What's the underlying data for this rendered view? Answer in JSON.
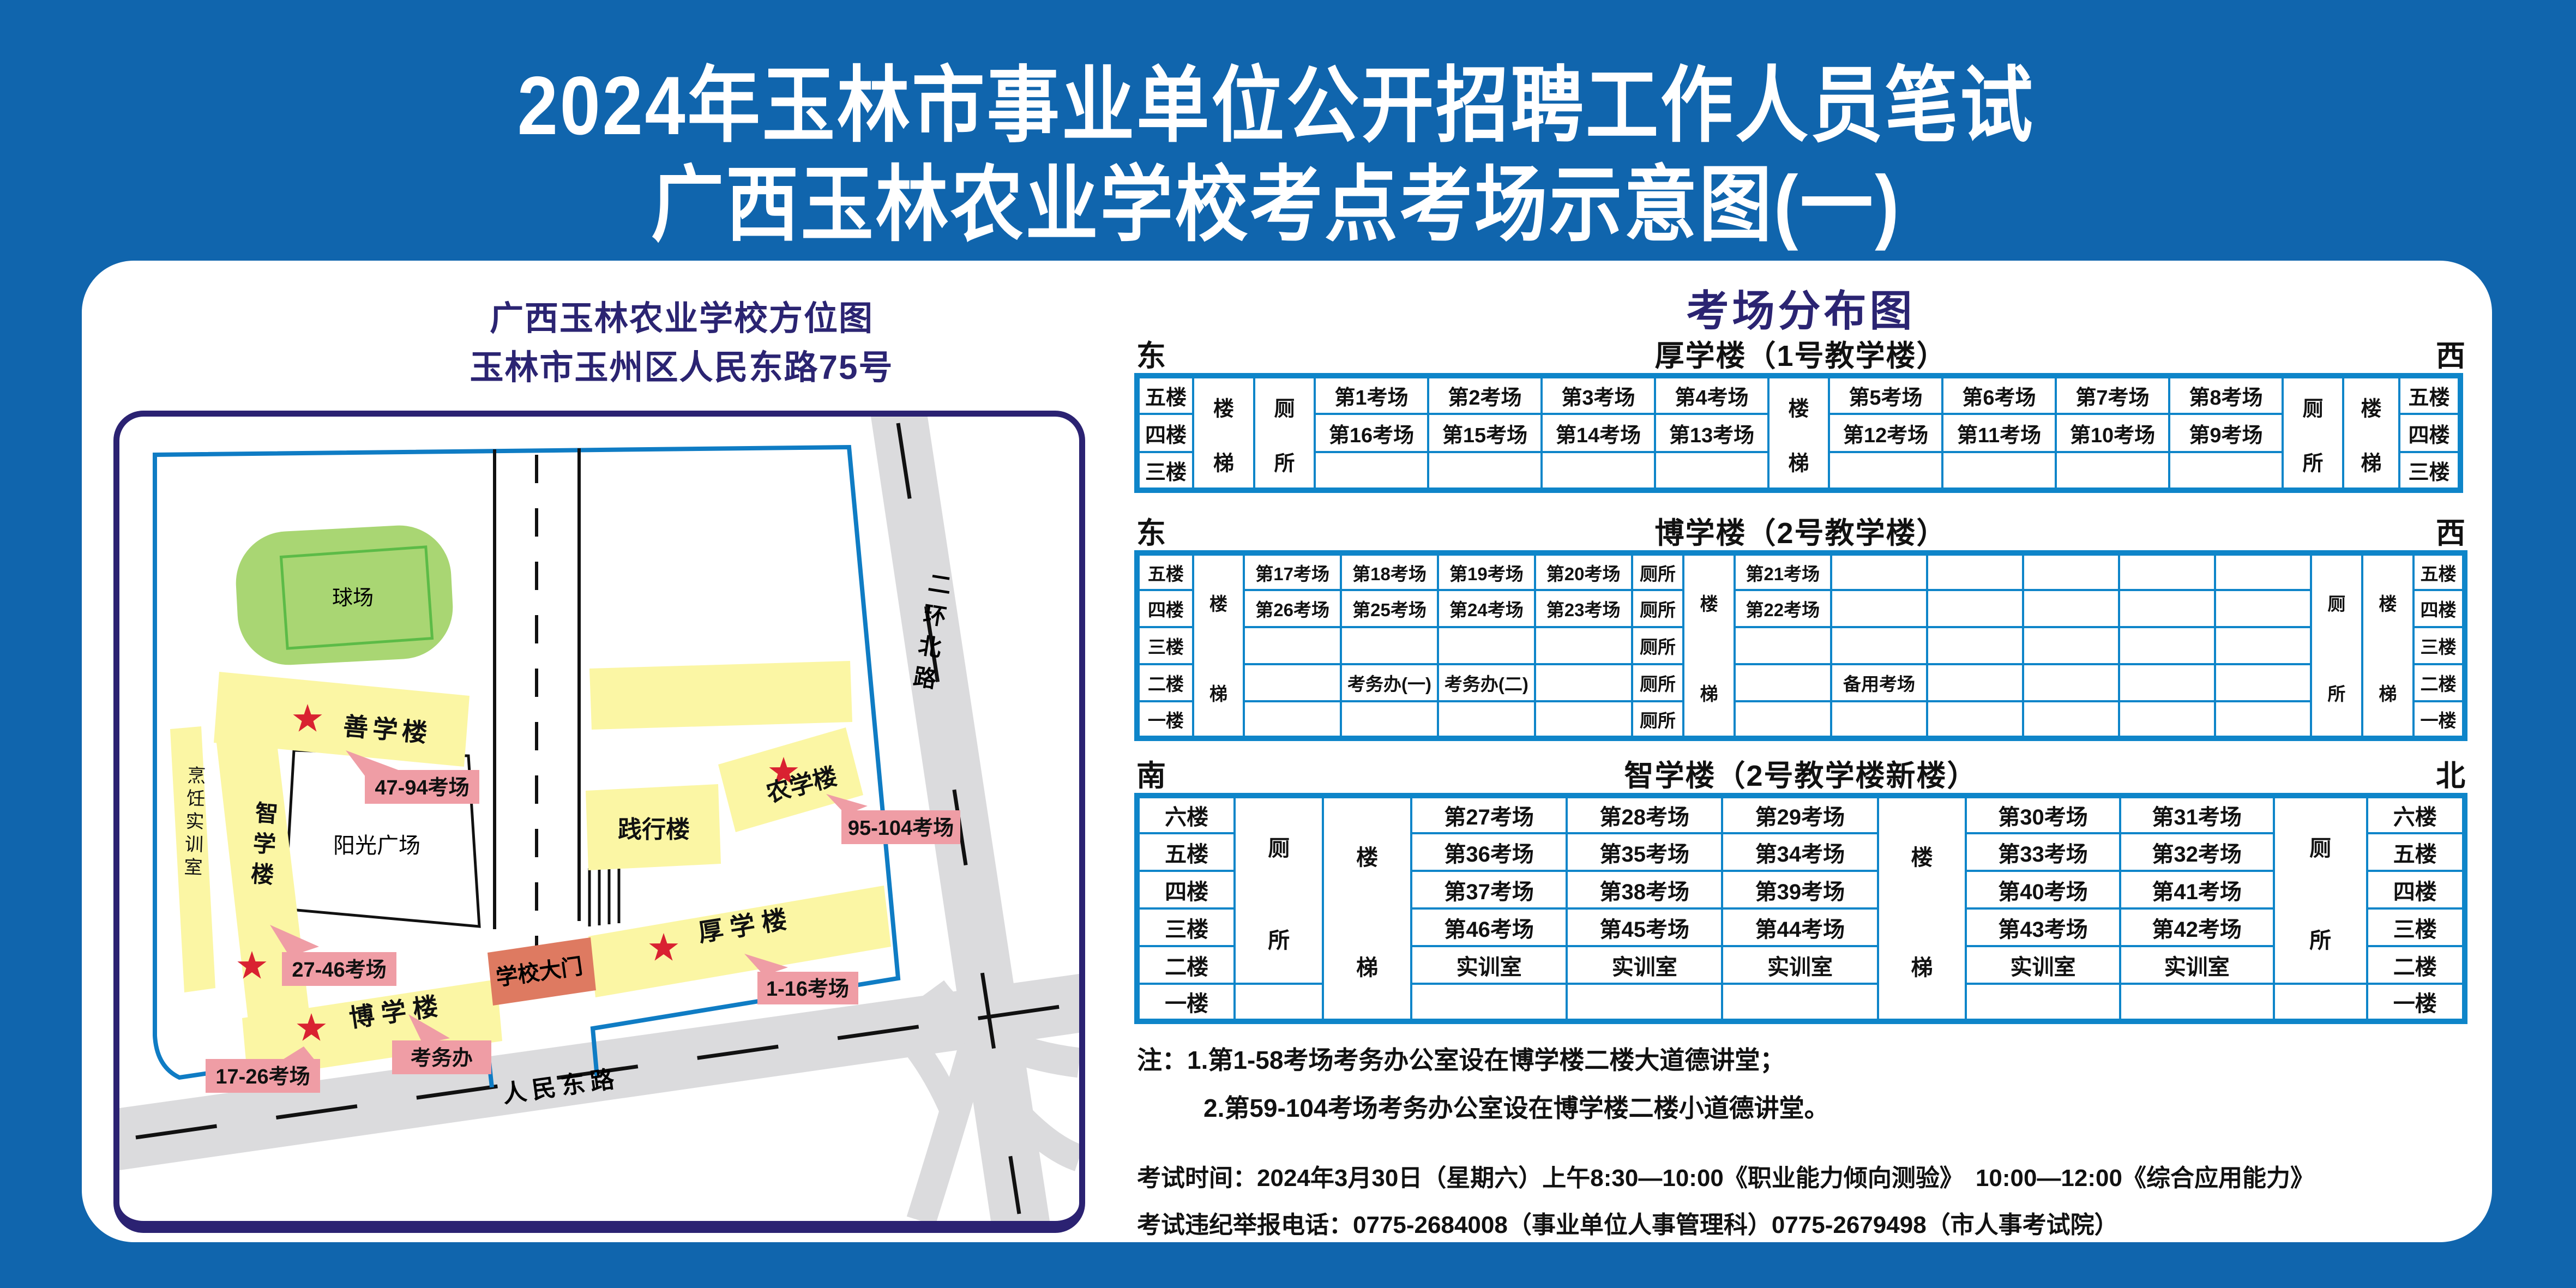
{
  "page": {
    "title_line1": "2024年玉林市事业单位公开招聘工作人员笔试",
    "title_line2": "广西玉林农业学校考点考场示意图(一)"
  },
  "map": {
    "title_line1": "广西玉林农业学校方位图",
    "title_line2": "玉林市玉州区人民东路75号",
    "labels": {
      "playground": "球场",
      "shanxue": "善学楼",
      "zhixue": "智学楼",
      "cooking": "烹饪实训室",
      "plaza": "阳光广场",
      "boxue": "博 学 楼",
      "gate": "学校大门",
      "houxue": "厚 学 楼",
      "jianxing": "践行楼",
      "nongxue": "农学楼",
      "renmin_road": "人民东路",
      "erhuan_road": "二环北路"
    },
    "tags": {
      "shanxue": "47-94考场",
      "zhixue": "27-46考场",
      "boxue": "17-26考场",
      "kaowuban": "考务办",
      "houxue": "1-16考场",
      "nongxue": "95-104考场"
    }
  },
  "distribution": {
    "title": "考场分布图",
    "tables": [
      {
        "id": "table1",
        "dir_left": "东",
        "dir_right": "西",
        "title": "厚学楼（1号教学楼）",
        "rh": 70,
        "cols": [
          103,
          112,
          111,
          208,
          208,
          208,
          208,
          111,
          208,
          208,
          208,
          208,
          111,
          103,
          112
        ],
        "rows": [
          [
            {
              "t": "五楼",
              "n": "floor-label-cell"
            },
            {
              "t": "楼梯",
              "v": 1,
              "rs": 3,
              "n": "stairs-cell"
            },
            {
              "t": "厕所",
              "v": 1,
              "rs": 3,
              "n": "toilet-cell"
            },
            {
              "t": "第1考场"
            },
            {
              "t": "第2考场"
            },
            {
              "t": "第3考场"
            },
            {
              "t": "第4考场"
            },
            {
              "t": "楼梯",
              "v": 1,
              "rs": 3,
              "n": "stairs-cell"
            },
            {
              "t": "第5考场"
            },
            {
              "t": "第6考场"
            },
            {
              "t": "第7考场"
            },
            {
              "t": "第8考场"
            },
            {
              "t": "厕所",
              "v": 1,
              "rs": 3,
              "n": "toilet-cell"
            },
            {
              "t": "楼梯",
              "v": 1,
              "rs": 3,
              "n": "stairs-cell"
            },
            {
              "t": "五楼",
              "n": "floor-label-cell"
            }
          ],
          [
            {
              "t": "四楼",
              "n": "floor-label-cell"
            },
            {
              "t": "第16考场"
            },
            {
              "t": "第15考场"
            },
            {
              "t": "第14考场"
            },
            {
              "t": "第13考场"
            },
            {
              "t": "第12考场"
            },
            {
              "t": "第11考场"
            },
            {
              "t": "第10考场"
            },
            {
              "t": "第9考场"
            },
            {
              "t": "四楼",
              "n": "floor-label-cell"
            }
          ],
          [
            {
              "t": "三楼",
              "n": "floor-label-cell"
            },
            {
              "t": ""
            },
            {
              "t": ""
            },
            {
              "t": ""
            },
            {
              "t": ""
            },
            {
              "t": ""
            },
            {
              "t": ""
            },
            {
              "t": ""
            },
            {
              "t": ""
            },
            {
              "t": "三楼",
              "n": "floor-label-cell"
            }
          ]
        ]
      },
      {
        "id": "table2",
        "dir_left": "东",
        "dir_right": "西",
        "title": "博学楼（2号教学楼）",
        "rh": 68,
        "cols": [
          103,
          94,
          178,
          178,
          178,
          178,
          95,
          94,
          177,
          177,
          177,
          177,
          177,
          177,
          94,
          95,
          94
        ],
        "rows": [
          [
            {
              "t": "五楼",
              "n": "floor-label-cell"
            },
            {
              "t": "楼梯",
              "v": 1,
              "rs": 5,
              "n": "stairs-cell"
            },
            {
              "t": "第17考场"
            },
            {
              "t": "第18考场"
            },
            {
              "t": "第19考场"
            },
            {
              "t": "第20考场"
            },
            {
              "t": "厕所",
              "n": "toilet-cell"
            },
            {
              "t": "楼梯",
              "v": 1,
              "rs": 5,
              "n": "stairs-cell"
            },
            {
              "t": "第21考场"
            },
            {
              "t": ""
            },
            {
              "t": ""
            },
            {
              "t": ""
            },
            {
              "t": ""
            },
            {
              "t": ""
            },
            {
              "t": "厕所",
              "v": 1,
              "rs": 5,
              "n": "toilet-cell"
            },
            {
              "t": "楼梯",
              "v": 1,
              "rs": 5,
              "n": "stairs-cell"
            },
            {
              "t": "五楼",
              "n": "floor-label-cell"
            }
          ],
          [
            {
              "t": "四楼",
              "n": "floor-label-cell"
            },
            {
              "t": "第26考场"
            },
            {
              "t": "第25考场"
            },
            {
              "t": "第24考场"
            },
            {
              "t": "第23考场"
            },
            {
              "t": "厕所",
              "n": "toilet-cell"
            },
            {
              "t": "第22考场"
            },
            {
              "t": ""
            },
            {
              "t": ""
            },
            {
              "t": ""
            },
            {
              "t": ""
            },
            {
              "t": ""
            },
            {
              "t": "四楼",
              "n": "floor-label-cell"
            }
          ],
          [
            {
              "t": "三楼",
              "n": "floor-label-cell"
            },
            {
              "t": ""
            },
            {
              "t": ""
            },
            {
              "t": ""
            },
            {
              "t": ""
            },
            {
              "t": "厕所",
              "n": "toilet-cell"
            },
            {
              "t": ""
            },
            {
              "t": ""
            },
            {
              "t": ""
            },
            {
              "t": ""
            },
            {
              "t": ""
            },
            {
              "t": ""
            },
            {
              "t": "三楼",
              "n": "floor-label-cell"
            }
          ],
          [
            {
              "t": "二楼",
              "n": "floor-label-cell"
            },
            {
              "t": ""
            },
            {
              "t": "考务办(一)"
            },
            {
              "t": "考务办(二)"
            },
            {
              "t": ""
            },
            {
              "t": "厕所",
              "n": "toilet-cell"
            },
            {
              "t": ""
            },
            {
              "t": "备用考场"
            },
            {
              "t": ""
            },
            {
              "t": ""
            },
            {
              "t": ""
            },
            {
              "t": ""
            },
            {
              "t": "二楼",
              "n": "floor-label-cell"
            }
          ],
          [
            {
              "t": "一楼",
              "n": "floor-label-cell"
            },
            {
              "t": ""
            },
            {
              "t": ""
            },
            {
              "t": ""
            },
            {
              "t": ""
            },
            {
              "t": "厕所",
              "n": "toilet-cell"
            },
            {
              "t": ""
            },
            {
              "t": ""
            },
            {
              "t": ""
            },
            {
              "t": ""
            },
            {
              "t": ""
            },
            {
              "t": ""
            },
            {
              "t": "一楼",
              "n": "floor-label-cell"
            }
          ]
        ]
      },
      {
        "id": "table3",
        "dir_left": "南",
        "dir_right": "北",
        "title": "智学楼（2号教学楼新楼）",
        "rh": 69,
        "cols": [
          180,
          163,
          163,
          286,
          286,
          286,
          163,
          283,
          283,
          172,
          180
        ],
        "rows": [
          [
            {
              "t": "六楼",
              "n": "floor-label-cell"
            },
            {
              "t": "厕所",
              "v": 1,
              "rs": 5,
              "n": "toilet-cell"
            },
            {
              "t": "楼梯",
              "v": 1,
              "rs": 6,
              "n": "stairs-cell"
            },
            {
              "t": "第27考场"
            },
            {
              "t": "第28考场"
            },
            {
              "t": "第29考场"
            },
            {
              "t": "楼梯",
              "v": 1,
              "rs": 6,
              "n": "stairs-cell"
            },
            {
              "t": "第30考场"
            },
            {
              "t": "第31考场"
            },
            {
              "t": "厕所",
              "v": 1,
              "rs": 5,
              "n": "toilet-cell"
            },
            {
              "t": "六楼",
              "n": "floor-label-cell"
            }
          ],
          [
            {
              "t": "五楼",
              "n": "floor-label-cell"
            },
            {
              "t": "第36考场"
            },
            {
              "t": "第35考场"
            },
            {
              "t": "第34考场"
            },
            {
              "t": "第33考场"
            },
            {
              "t": "第32考场"
            },
            {
              "t": "五楼",
              "n": "floor-label-cell"
            }
          ],
          [
            {
              "t": "四楼",
              "n": "floor-label-cell"
            },
            {
              "t": "第37考场"
            },
            {
              "t": "第38考场"
            },
            {
              "t": "第39考场"
            },
            {
              "t": "第40考场"
            },
            {
              "t": "第41考场"
            },
            {
              "t": "四楼",
              "n": "floor-label-cell"
            }
          ],
          [
            {
              "t": "三楼",
              "n": "floor-label-cell"
            },
            {
              "t": "第46考场"
            },
            {
              "t": "第45考场"
            },
            {
              "t": "第44考场"
            },
            {
              "t": "第43考场"
            },
            {
              "t": "第42考场"
            },
            {
              "t": "三楼",
              "n": "floor-label-cell"
            }
          ],
          [
            {
              "t": "二楼",
              "n": "floor-label-cell"
            },
            {
              "t": "实训室"
            },
            {
              "t": "实训室"
            },
            {
              "t": "实训室"
            },
            {
              "t": "实训室"
            },
            {
              "t": "实训室"
            },
            {
              "t": "二楼",
              "n": "floor-label-cell"
            }
          ],
          [
            {
              "t": "一楼",
              "n": "floor-label-cell"
            },
            {
              "t": ""
            },
            {
              "t": ""
            },
            {
              "t": ""
            },
            {
              "t": ""
            },
            {
              "t": ""
            },
            {
              "t": ""
            },
            {
              "t": ""
            },
            {
              "t": "一楼",
              "n": "floor-label-cell"
            }
          ]
        ]
      }
    ]
  },
  "notes": {
    "line1": "注：1.第1-58考场考务办公室设在博学楼二楼大道德讲堂；",
    "line2": "2.第59-104考场考务办公室设在博学楼二楼小道德讲堂。",
    "line3": "考试时间：2024年3月30日（星期六）上午8:30—10:00《职业能力倾向测验》　10:00—12:00《综合应用能力》",
    "line4": "考试违纪举报电话：0775-2684008（事业单位人事管理科）0775-2679498（市人事考试院）"
  },
  "colors": {
    "background": "#1065AD",
    "navy": "#2B2472",
    "table_border": "#0E85C9",
    "building_yellow": "#FBF6A4",
    "tag_pink": "#EF9DA5",
    "gate_red": "#DE7A61",
    "road_gray": "#DBDBDD",
    "field_green": "#A9D673",
    "star_red": "#D92231",
    "boundary_blue": "#0F7CC4"
  }
}
